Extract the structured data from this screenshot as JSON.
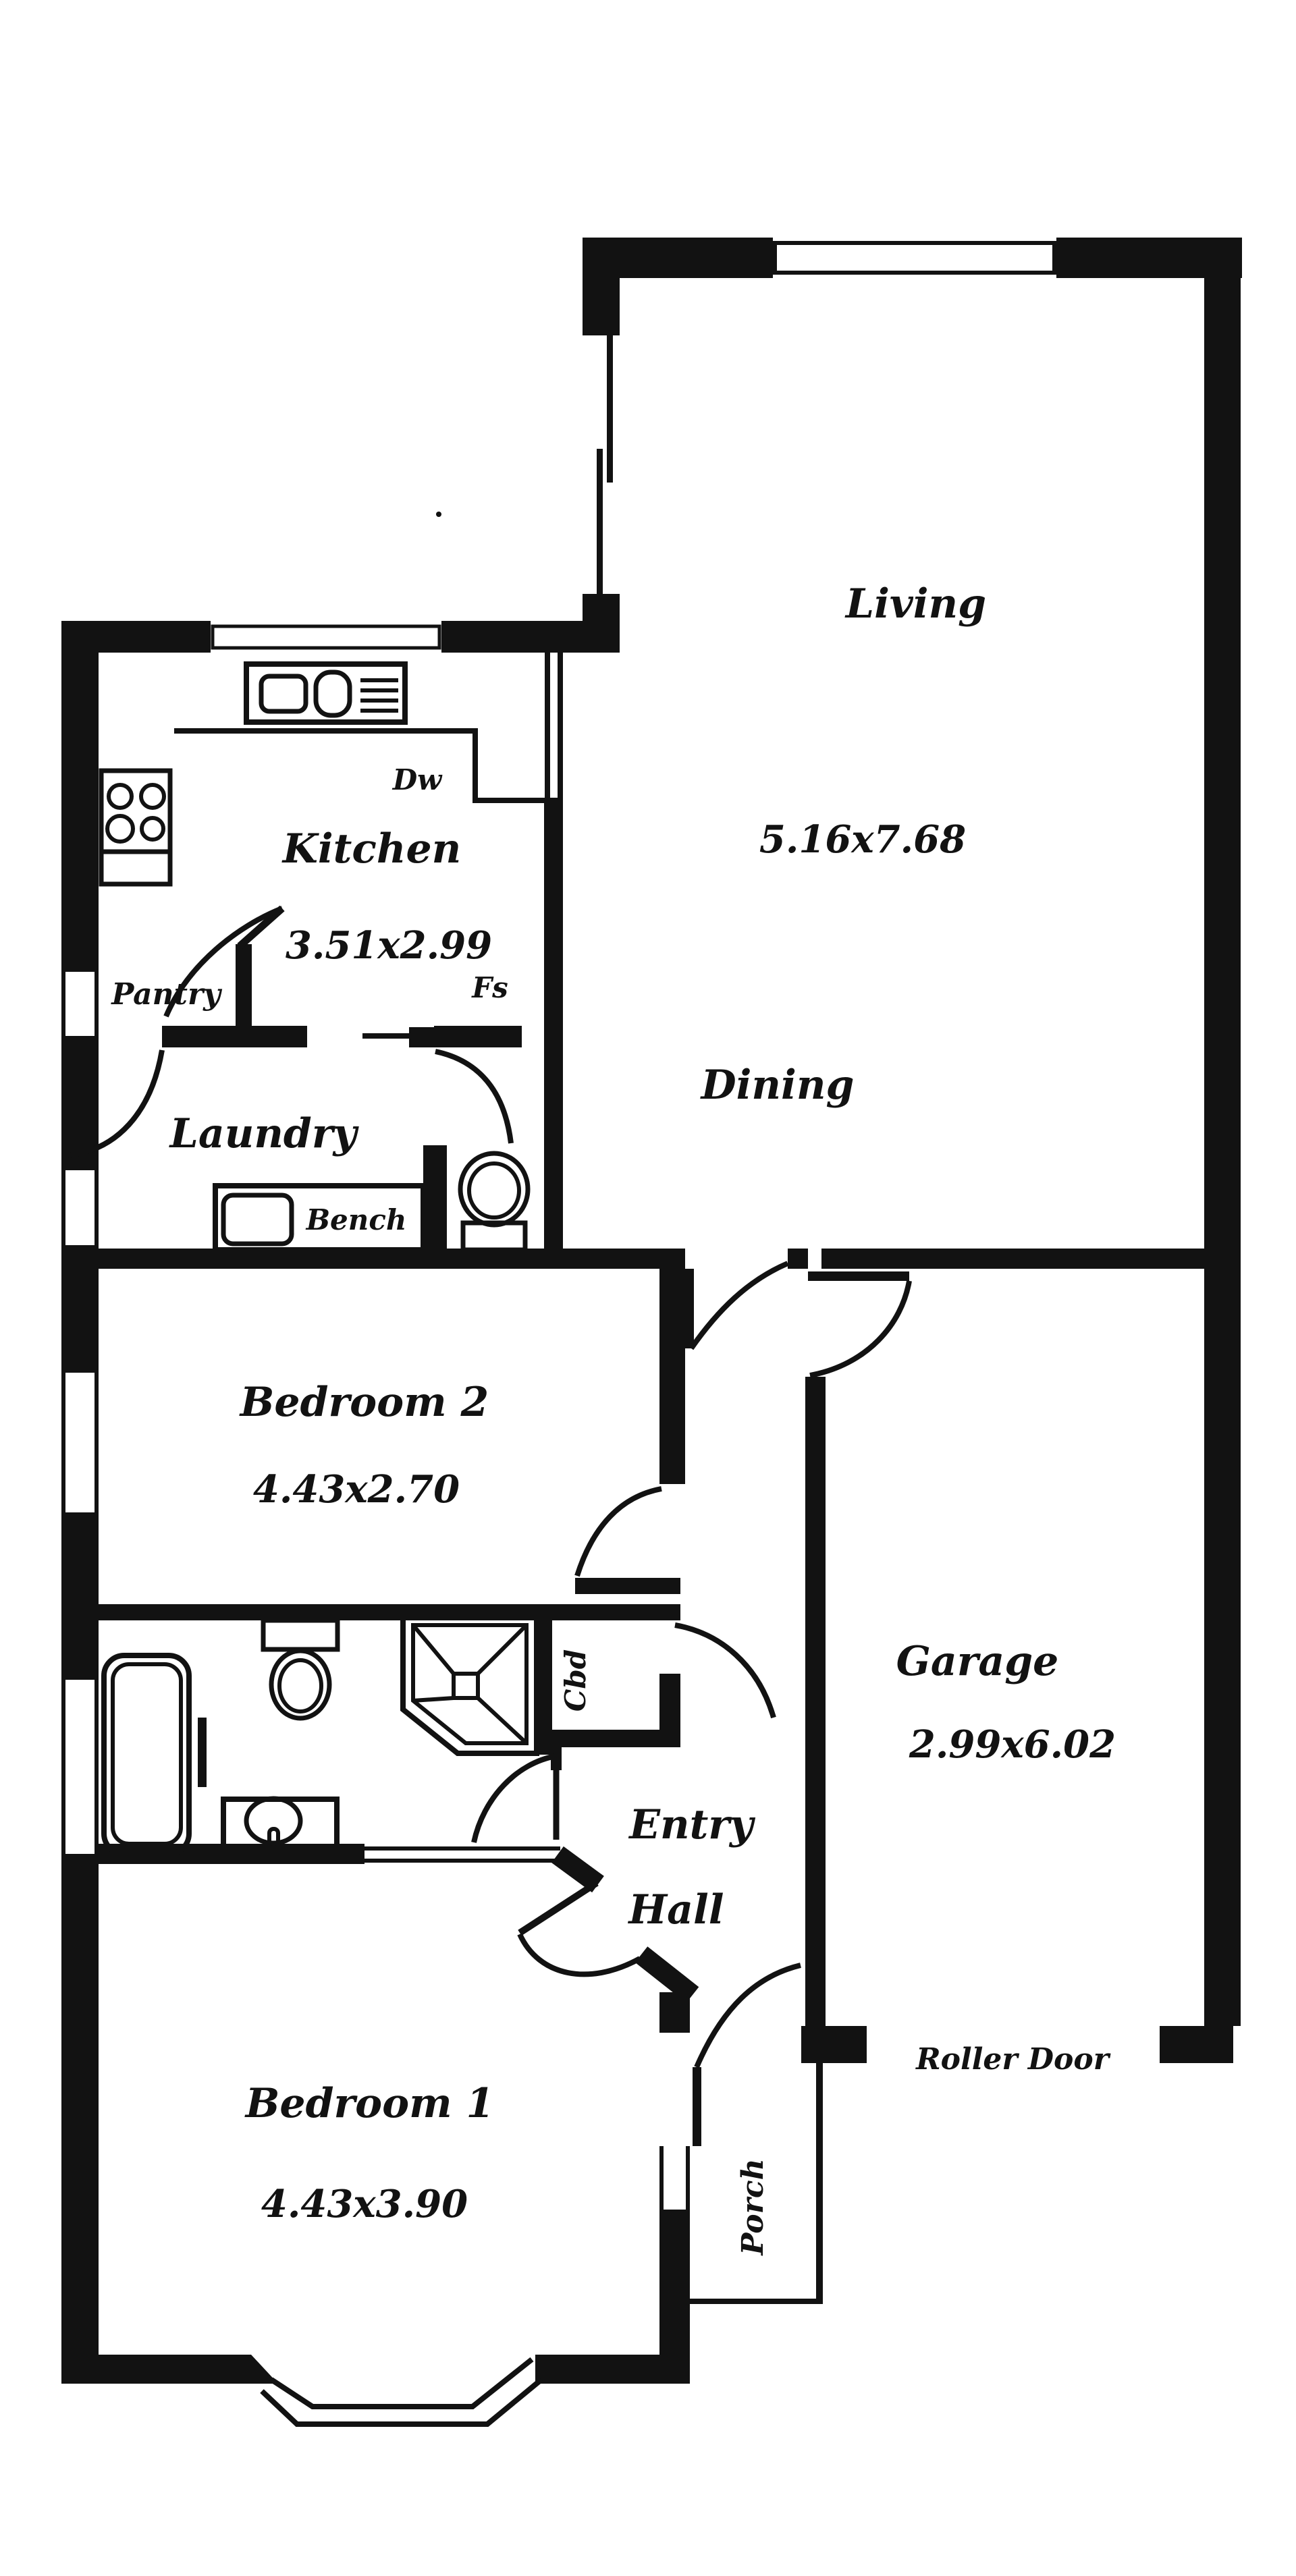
{
  "plan": {
    "rooms": {
      "living": {
        "name": "Living",
        "dims": "5.16x7.68"
      },
      "dining": {
        "name": "Dining"
      },
      "kitchen": {
        "name": "Kitchen",
        "dims": "3.51x2.99"
      },
      "pantry": {
        "name": "Pantry"
      },
      "laundry": {
        "name": "Laundry"
      },
      "bedroom2": {
        "name": "Bedroom 2",
        "dims": "4.43x2.70"
      },
      "garage": {
        "name": "Garage",
        "dims": "2.99x6.02"
      },
      "entry": {
        "line1": "Entry",
        "line2": "Hall"
      },
      "bedroom1": {
        "name": "Bedroom 1",
        "dims": "4.43x3.90"
      },
      "porch": {
        "name": "Porch"
      }
    },
    "fixtures": {
      "dishwasher": "Dw",
      "fridge_space": "Fs",
      "bench": "Bench",
      "cupboard": "Cbd",
      "roller_door": "Roller Door"
    },
    "colors": {
      "ink": "#121212",
      "paper": "#ffffff"
    }
  }
}
